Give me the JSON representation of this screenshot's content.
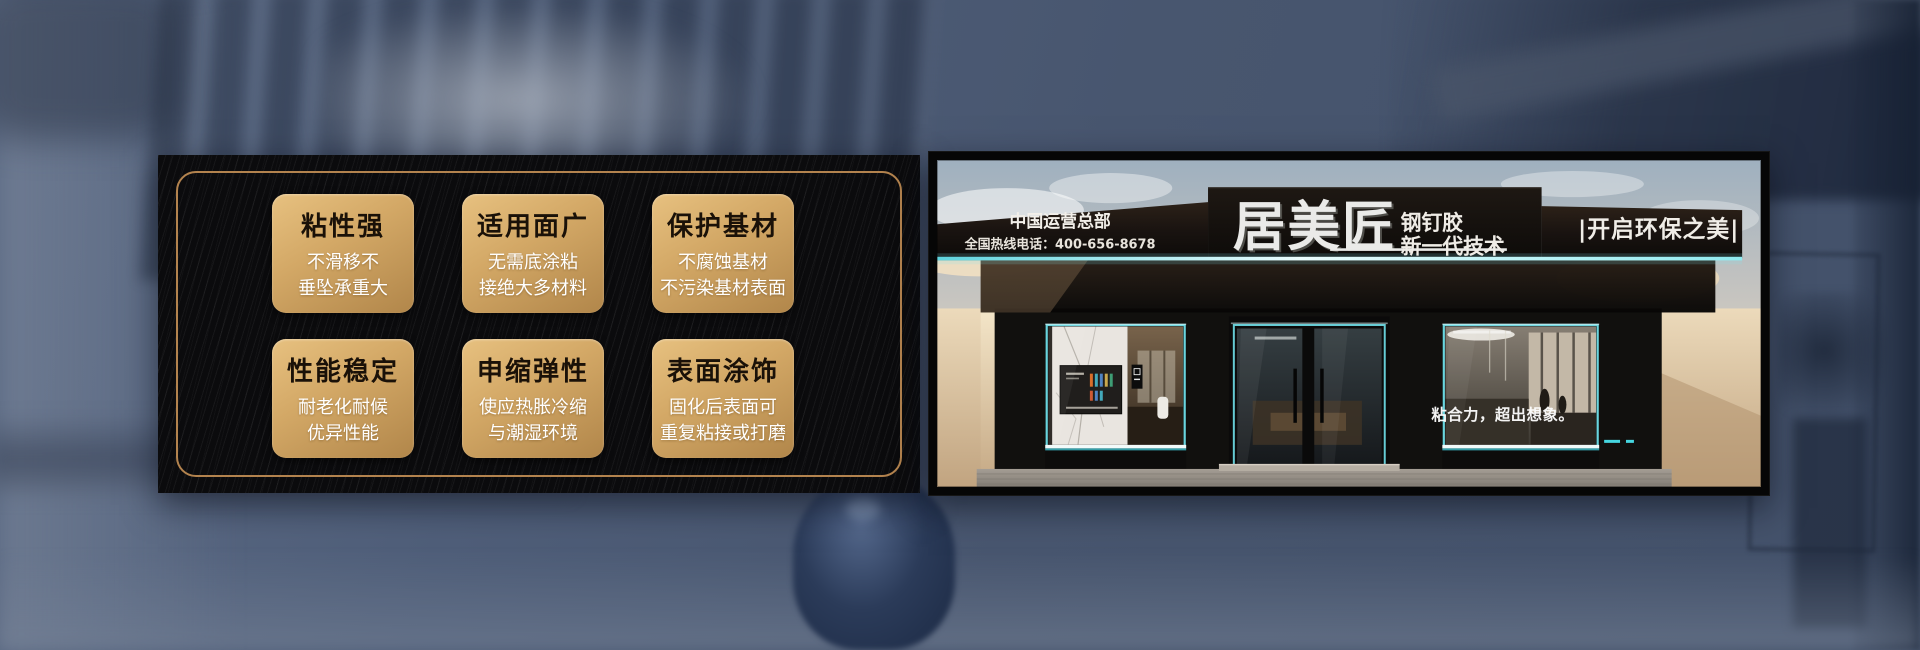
{
  "features": {
    "cards": [
      {
        "title": "粘性强",
        "lines": [
          "不滑移不",
          "垂坠承重大"
        ]
      },
      {
        "title": "适用面广",
        "lines": [
          "无需底涂粘",
          "接绝大多材料"
        ]
      },
      {
        "title": "保护基材",
        "lines": [
          "不腐蚀基材",
          "不污染基材表面"
        ]
      },
      {
        "title": "性能稳定",
        "lines": [
          "耐老化耐候",
          "优异性能"
        ]
      },
      {
        "title": "申缩弹性",
        "lines": [
          "使应热胀冷缩",
          "与潮湿环境"
        ]
      },
      {
        "title": "表面涂饰",
        "lines": [
          "固化后表面可",
          "重复粘接或打磨"
        ]
      }
    ]
  },
  "storefront": {
    "sign": {
      "hq_label": "中国运营总部",
      "hotline": "全国热线电话：400-656-8678",
      "brand": "居美匠",
      "product": "钢钉胶",
      "tech_line": "新一代技术",
      "slogan": "|开启环保之美|"
    },
    "window_slogan": "粘合力，超出想象。"
  },
  "colors": {
    "gold_light": "#e7c180",
    "gold_dark": "#b1864a",
    "panel_black": "#0b0b0d",
    "frame_gold": "#b3834e",
    "led_cyan": "#7fe3ec",
    "bg_slate": "#4c5971"
  }
}
